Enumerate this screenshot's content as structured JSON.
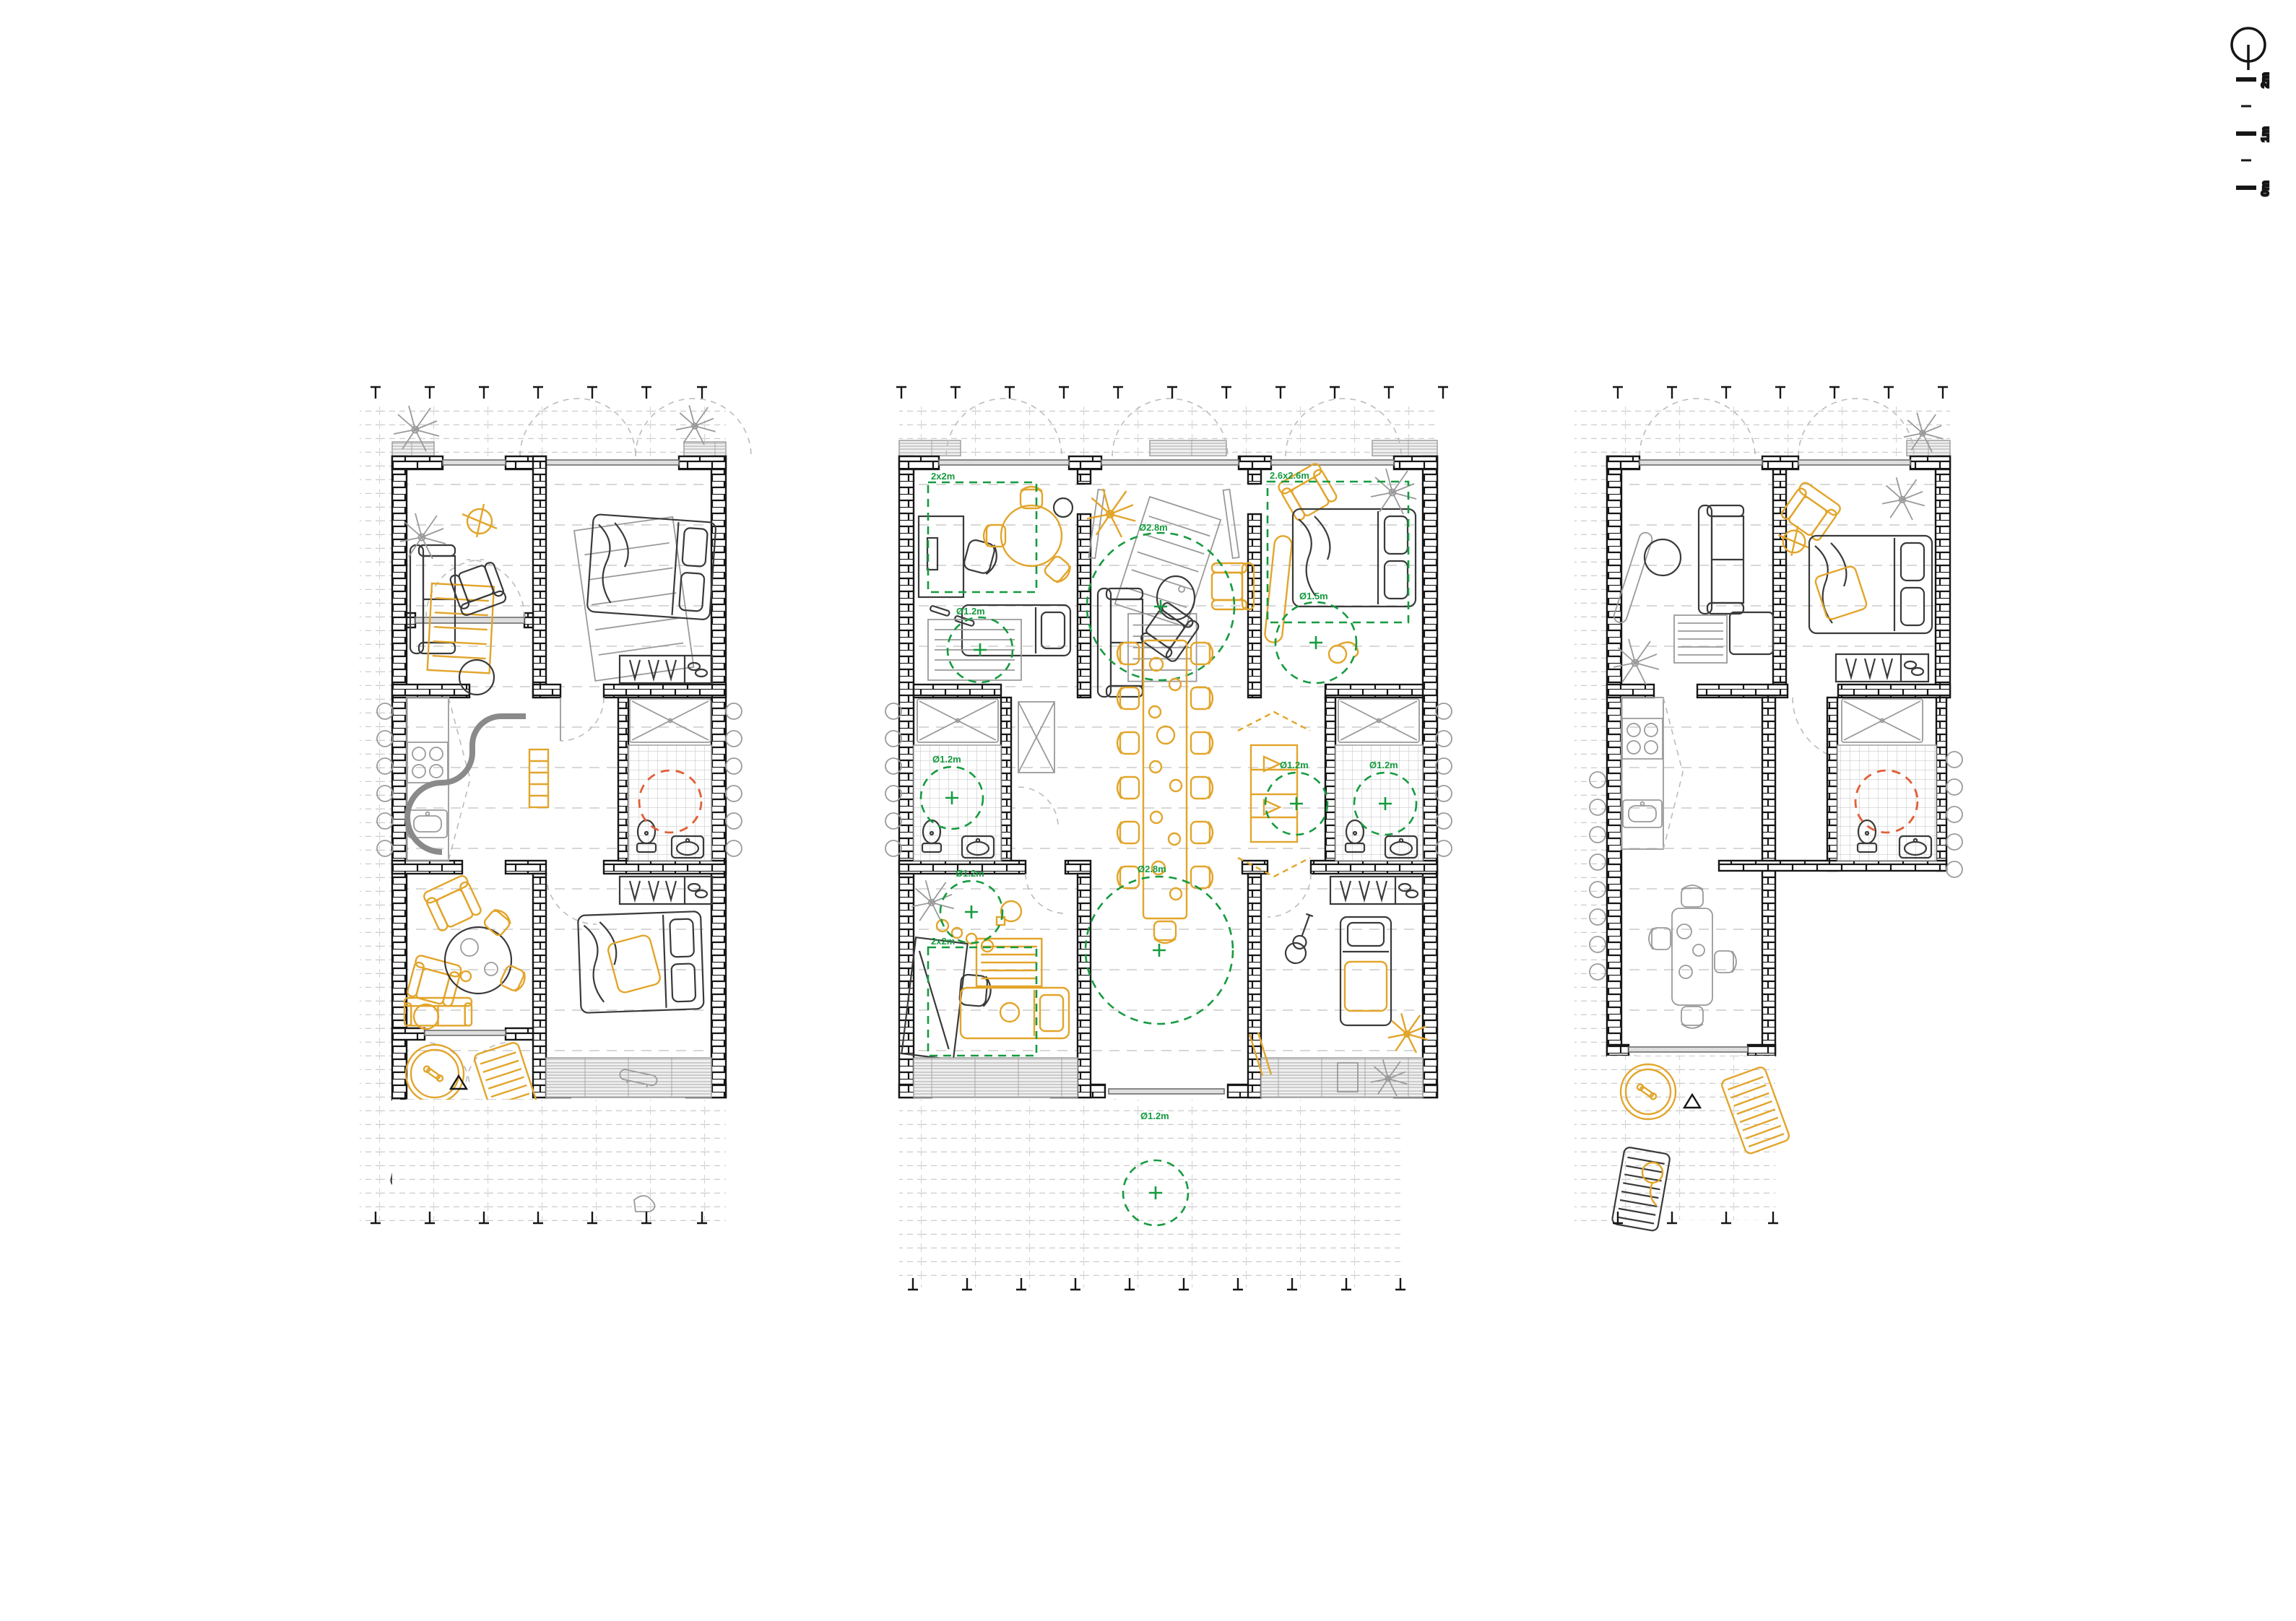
{
  "legend": {
    "north_icon": "north-arrow",
    "scale_labels": [
      "2m",
      "1m",
      "0m"
    ]
  },
  "colors": {
    "wall": "#161616",
    "furniture_dark": "#3a3a3a",
    "furniture_light": "#9a9a9a",
    "accent_yellow": "#E2A52B",
    "annotation_green": "#169B3F",
    "bathroom_circle_orange": "#E0603A"
  },
  "annotations": [
    {
      "text": "2x2m"
    },
    {
      "text": "Ø1.2m"
    },
    {
      "text": "Ø2.8m"
    },
    {
      "text": "2.6x2.6m"
    },
    {
      "text": "Ø1.5m"
    },
    {
      "text": "Ø1.2m"
    },
    {
      "text": "Ø1.2m"
    },
    {
      "text": "Ø1.2m"
    },
    {
      "text": "Ø2.8m"
    },
    {
      "text": "Ø1.2m"
    },
    {
      "text": "2x2m"
    },
    {
      "text": "Ø1.2m"
    }
  ]
}
